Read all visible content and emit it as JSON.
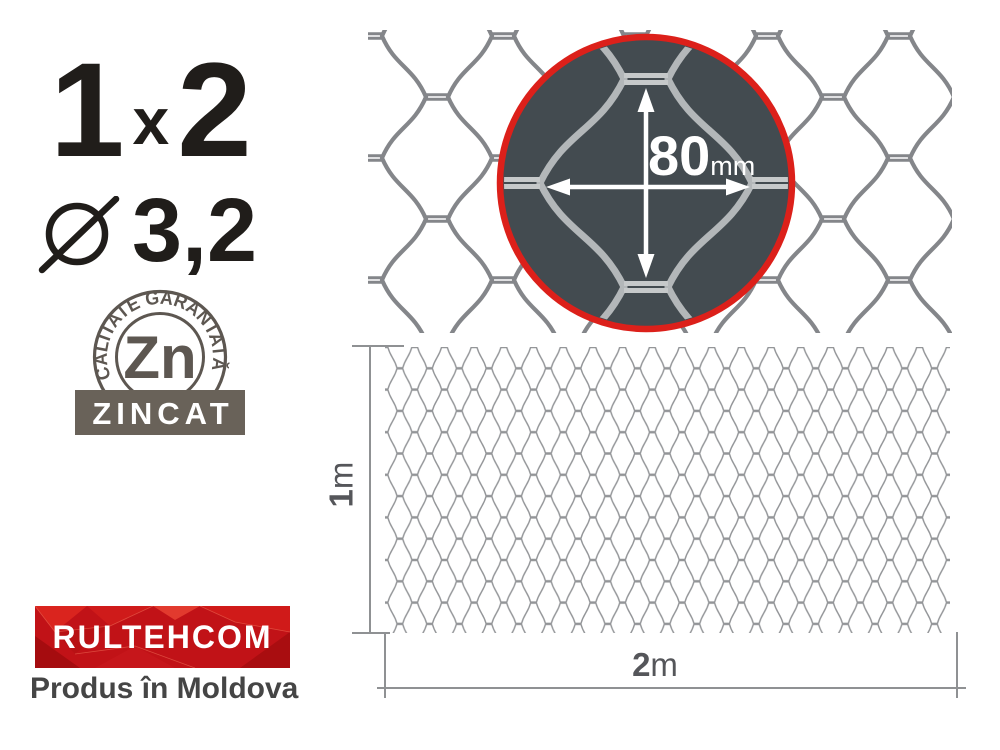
{
  "size": {
    "height": "1",
    "separator": "x",
    "width": "2"
  },
  "diameter": {
    "symbol": "⌀",
    "value": "3,2"
  },
  "quality_badge": {
    "arc_text": "CALITATE GARANTATĂ",
    "element_symbol": "Zn",
    "banner_text": "ZINCAT"
  },
  "brand": {
    "name": "RULTEHCOM",
    "origin_text": "Produs în Moldova"
  },
  "magnifier": {
    "value": "80",
    "unit": "mm"
  },
  "dimensions": {
    "height": {
      "value": "1",
      "unit": "m"
    },
    "width": {
      "value": "2",
      "unit": "m"
    }
  },
  "colors": {
    "text_dark": "#201d1a",
    "wire_gray": "#84868a",
    "fine_wire_gray": "#939598",
    "magnifier_fill": "#434b50",
    "magnifier_ring_red": "#dc201a",
    "magnifier_wire": "#b3b7b9",
    "badge_gray": "#5d5751",
    "zincat_banner_gray": "#696259",
    "brand_red": "#c11217",
    "dim_line_gray": "#8f9193"
  }
}
